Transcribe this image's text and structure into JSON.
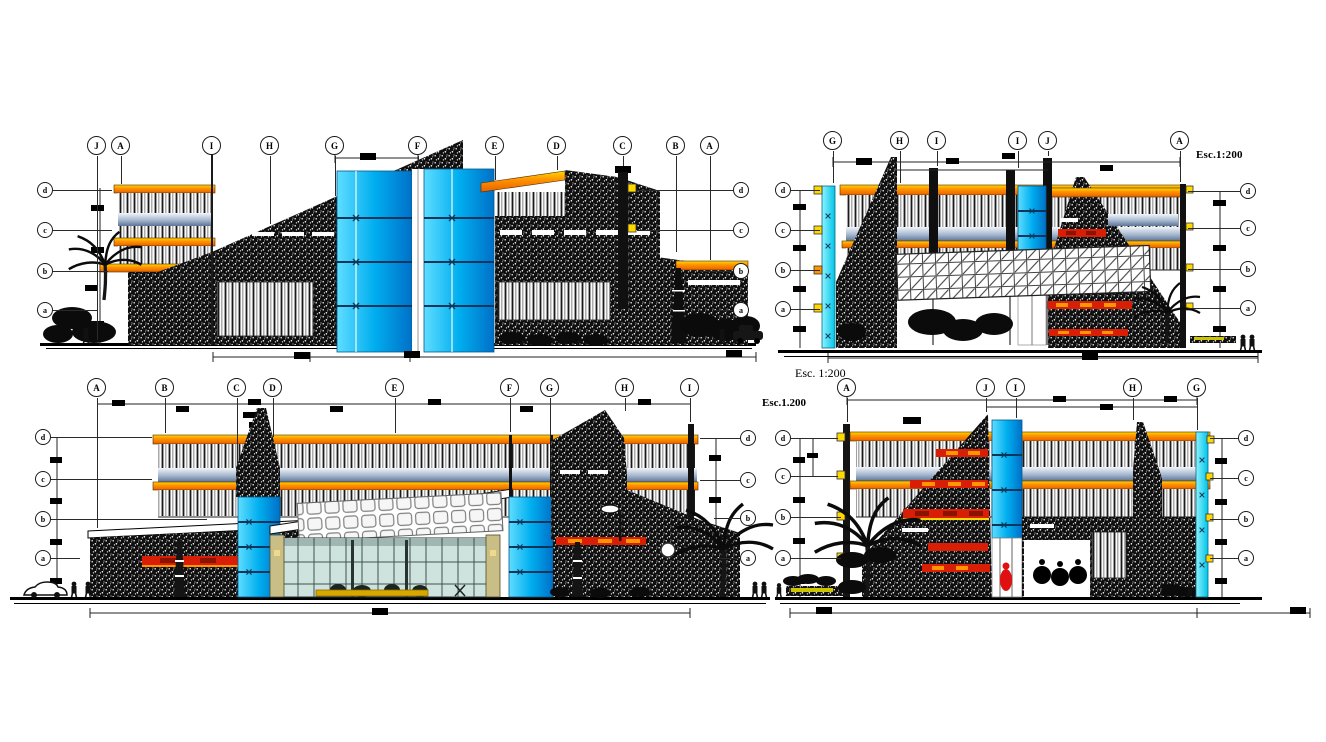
{
  "document": {
    "background": "#ffffff",
    "width": 1326,
    "height": 742,
    "kind": "building elevation drawing"
  },
  "annotations": {
    "scale_top_right": "Esc.1:200",
    "scale_mid_serif": "Esc. 1:200",
    "scale_mid_bold": "Esc.1.200"
  },
  "colors": {
    "paper": "#ffffff",
    "ink": "#141414",
    "orange_hi": "#FFD800",
    "orange_mid": "#FF9500",
    "orange_deep": "#E86000",
    "band_red": "#D81E05",
    "band_red_dark": "#8A1200",
    "glass_light": "#5FDDFF",
    "glass_mid": "#00AEEF",
    "glass_deep": "#0070C8",
    "cyan_light": "#8FF2FF",
    "cyan_deep": "#00C4E8",
    "steel_light": "#F2F6FB",
    "steel_mid": "#A5B7CE",
    "steel_deep": "#5E7396",
    "entry_glass": "#CFE3DE",
    "entry_mullion": "#3F514C",
    "khaki": "#C9BE85",
    "counter_yellow": "#D9A800",
    "garden_yellow": "#CCC400",
    "foliage": "#0B0B0B",
    "mark_blue": "#0A3A5C"
  },
  "panels": [
    {
      "name": "elevation-top-left",
      "bubble_row_y": 146,
      "bubbles": [
        {
          "label": "J",
          "x": 97,
          "stem_to": 340
        },
        {
          "label": "A",
          "x": 121,
          "stem_to": 184
        },
        {
          "label": "I",
          "x": 212,
          "stem_to": 142
        },
        {
          "label": "H",
          "x": 270,
          "stem_to": 224
        },
        {
          "label": "G",
          "x": 335,
          "stem_to": 196
        },
        {
          "label": "F",
          "x": 418,
          "stem_to": 162
        },
        {
          "label": "E",
          "x": 495,
          "stem_to": 180
        },
        {
          "label": "D",
          "x": 557,
          "stem_to": 170
        },
        {
          "label": "C",
          "x": 623,
          "stem_to": 166
        },
        {
          "label": "B",
          "x": 676,
          "stem_to": 252
        },
        {
          "label": "A",
          "x": 710,
          "stem_to": 260
        }
      ],
      "levels_left": {
        "x": 45,
        "items": [
          {
            "label": "d",
            "y": 190,
            "to": 112
          },
          {
            "label": "c",
            "y": 230,
            "to": 112
          },
          {
            "label": "b",
            "y": 271,
            "to": 108
          },
          {
            "label": "a",
            "y": 310,
            "to": 98
          }
        ]
      },
      "levels_right": {
        "x": 741,
        "items": [
          {
            "label": "d",
            "y": 190,
            "to": 637
          },
          {
            "label": "c",
            "y": 230,
            "to": 637
          },
          {
            "label": "b",
            "y": 271,
            "to": 700
          },
          {
            "label": "a",
            "y": 310,
            "to": 714
          }
        ]
      }
    },
    {
      "name": "elevation-top-right",
      "bubble_row_y": 141,
      "bubbles": [
        {
          "label": "G",
          "x": 833,
          "stem_to": 183
        },
        {
          "label": "H",
          "x": 900,
          "stem_to": 183
        },
        {
          "label": "I",
          "x": 937,
          "stem_to": 166
        },
        {
          "label": "I",
          "x": 1018,
          "stem_to": 168
        },
        {
          "label": "J",
          "x": 1048,
          "stem_to": 156
        },
        {
          "label": "A",
          "x": 1180,
          "stem_to": 182
        }
      ],
      "levels_left": {
        "x": 783,
        "items": [
          {
            "label": "d",
            "y": 190,
            "to": 820
          },
          {
            "label": "c",
            "y": 230,
            "to": 820
          },
          {
            "label": "b",
            "y": 270,
            "to": 820
          },
          {
            "label": "a",
            "y": 309,
            "to": 820
          }
        ]
      },
      "levels_right": {
        "x": 1248,
        "items": [
          {
            "label": "d",
            "y": 191,
            "to": 1188
          },
          {
            "label": "c",
            "y": 228,
            "to": 1188
          },
          {
            "label": "b",
            "y": 269,
            "to": 1188
          },
          {
            "label": "a",
            "y": 308,
            "to": 1188
          }
        ]
      }
    },
    {
      "name": "elevation-bottom-left",
      "bubble_row_y": 388,
      "bubbles": [
        {
          "label": "A",
          "x": 97,
          "stem_to": 528
        },
        {
          "label": "B",
          "x": 165,
          "stem_to": 433
        },
        {
          "label": "C",
          "x": 237,
          "stem_to": 466
        },
        {
          "label": "D",
          "x": 273,
          "stem_to": 437
        },
        {
          "label": "E",
          "x": 395,
          "stem_to": 433
        },
        {
          "label": "F",
          "x": 510,
          "stem_to": 432
        },
        {
          "label": "G",
          "x": 550,
          "stem_to": 438
        },
        {
          "label": "H",
          "x": 625,
          "stem_to": 411
        },
        {
          "label": "I",
          "x": 690,
          "stem_to": 422
        }
      ],
      "levels_left": {
        "x": 43,
        "items": [
          {
            "label": "d",
            "y": 437,
            "to": 152
          },
          {
            "label": "c",
            "y": 479,
            "to": 152
          },
          {
            "label": "b",
            "y": 519,
            "to": 207
          },
          {
            "label": "a",
            "y": 558,
            "to": 80
          }
        ]
      },
      "levels_right": {
        "x": 748,
        "items": [
          {
            "label": "d",
            "y": 438,
            "to": 700
          },
          {
            "label": "c",
            "y": 480,
            "to": 700
          },
          {
            "label": "b",
            "y": 518,
            "to": 714
          },
          {
            "label": "a",
            "y": 558,
            "to": 714
          }
        ]
      }
    },
    {
      "name": "elevation-bottom-right",
      "bubble_row_y": 388,
      "bubbles": [
        {
          "label": "A",
          "x": 847,
          "stem_to": 422
        },
        {
          "label": "J",
          "x": 986,
          "stem_to": 412
        },
        {
          "label": "I",
          "x": 1016,
          "stem_to": 418
        },
        {
          "label": "H",
          "x": 1133,
          "stem_to": 420
        },
        {
          "label": "G",
          "x": 1197,
          "stem_to": 430
        }
      ],
      "levels_left": {
        "x": 783,
        "items": [
          {
            "label": "d",
            "y": 438,
            "to": 838
          },
          {
            "label": "c",
            "y": 476,
            "to": 838
          },
          {
            "label": "b",
            "y": 517,
            "to": 841
          },
          {
            "label": "a",
            "y": 558,
            "to": 841
          }
        ]
      },
      "levels_right": {
        "x": 1246,
        "items": [
          {
            "label": "d",
            "y": 438,
            "to": 1210
          },
          {
            "label": "c",
            "y": 478,
            "to": 1210
          },
          {
            "label": "b",
            "y": 519,
            "to": 1210
          },
          {
            "label": "a",
            "y": 558,
            "to": 1210
          }
        ]
      }
    }
  ]
}
